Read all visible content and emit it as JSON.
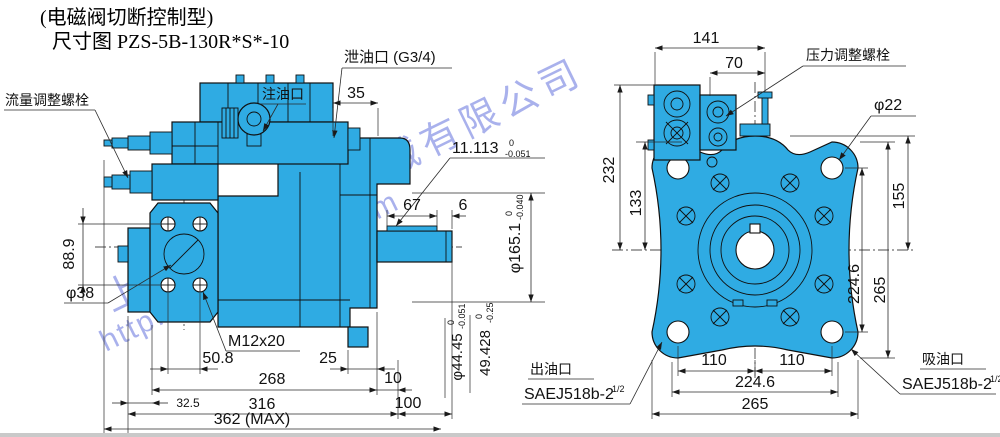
{
  "title": {
    "line1": "(电磁阀切断控制型)",
    "line2": "尺寸图 PZS-5B-130R*S*-10"
  },
  "watermark": {
    "company": "上海台拓液压机械有限公司",
    "url": "http://www.ttyytw.com"
  },
  "colors": {
    "body_fill": "#2fabe3",
    "line": "#101010",
    "watermark": "#4353d6",
    "background": "#ffffff"
  },
  "left": {
    "labels": {
      "flow_adjust": "流量调整螺栓",
      "fill_port": "注油口",
      "drain_port": "泄油口 (G3/4)",
      "phi38": "φ38",
      "m12": "M12x20"
    },
    "tol": {
      "key": {
        "val": "11.113",
        "up": "0",
        "dn": "-0.051"
      },
      "pilot": {
        "val": "φ165.1",
        "up": "0",
        "dn": "-0.040"
      },
      "port_d": {
        "val": "φ44.45",
        "up": "0",
        "dn": "-0.051"
      },
      "port_h": {
        "val": "49.428",
        "up": "0",
        "dn": "-0.25"
      }
    },
    "dims": {
      "d35": "35",
      "d67": "67",
      "d6": "6",
      "d889": "88.9",
      "d508": "50.8",
      "d25": "25",
      "d268": "268",
      "d10": "10",
      "d325": "32.5",
      "d316": "316",
      "d100": "100",
      "d362": "362 (MAX)"
    }
  },
  "right": {
    "labels": {
      "pressure_adjust": "压力调整螺栓",
      "phi22": "φ22",
      "outlet": "出油口",
      "outlet_spec": "SAEJ518b-2",
      "inlet": "吸油口",
      "inlet_spec": "SAEJ518b-2",
      "half": "1/2"
    },
    "dims": {
      "d141": "141",
      "d70": "70",
      "d232": "232",
      "d133": "133",
      "d155": "155",
      "d2246v": "224.6",
      "d265v": "265",
      "d110l": "110",
      "d110r": "110",
      "d2246": "224.6",
      "d265": "265"
    }
  }
}
